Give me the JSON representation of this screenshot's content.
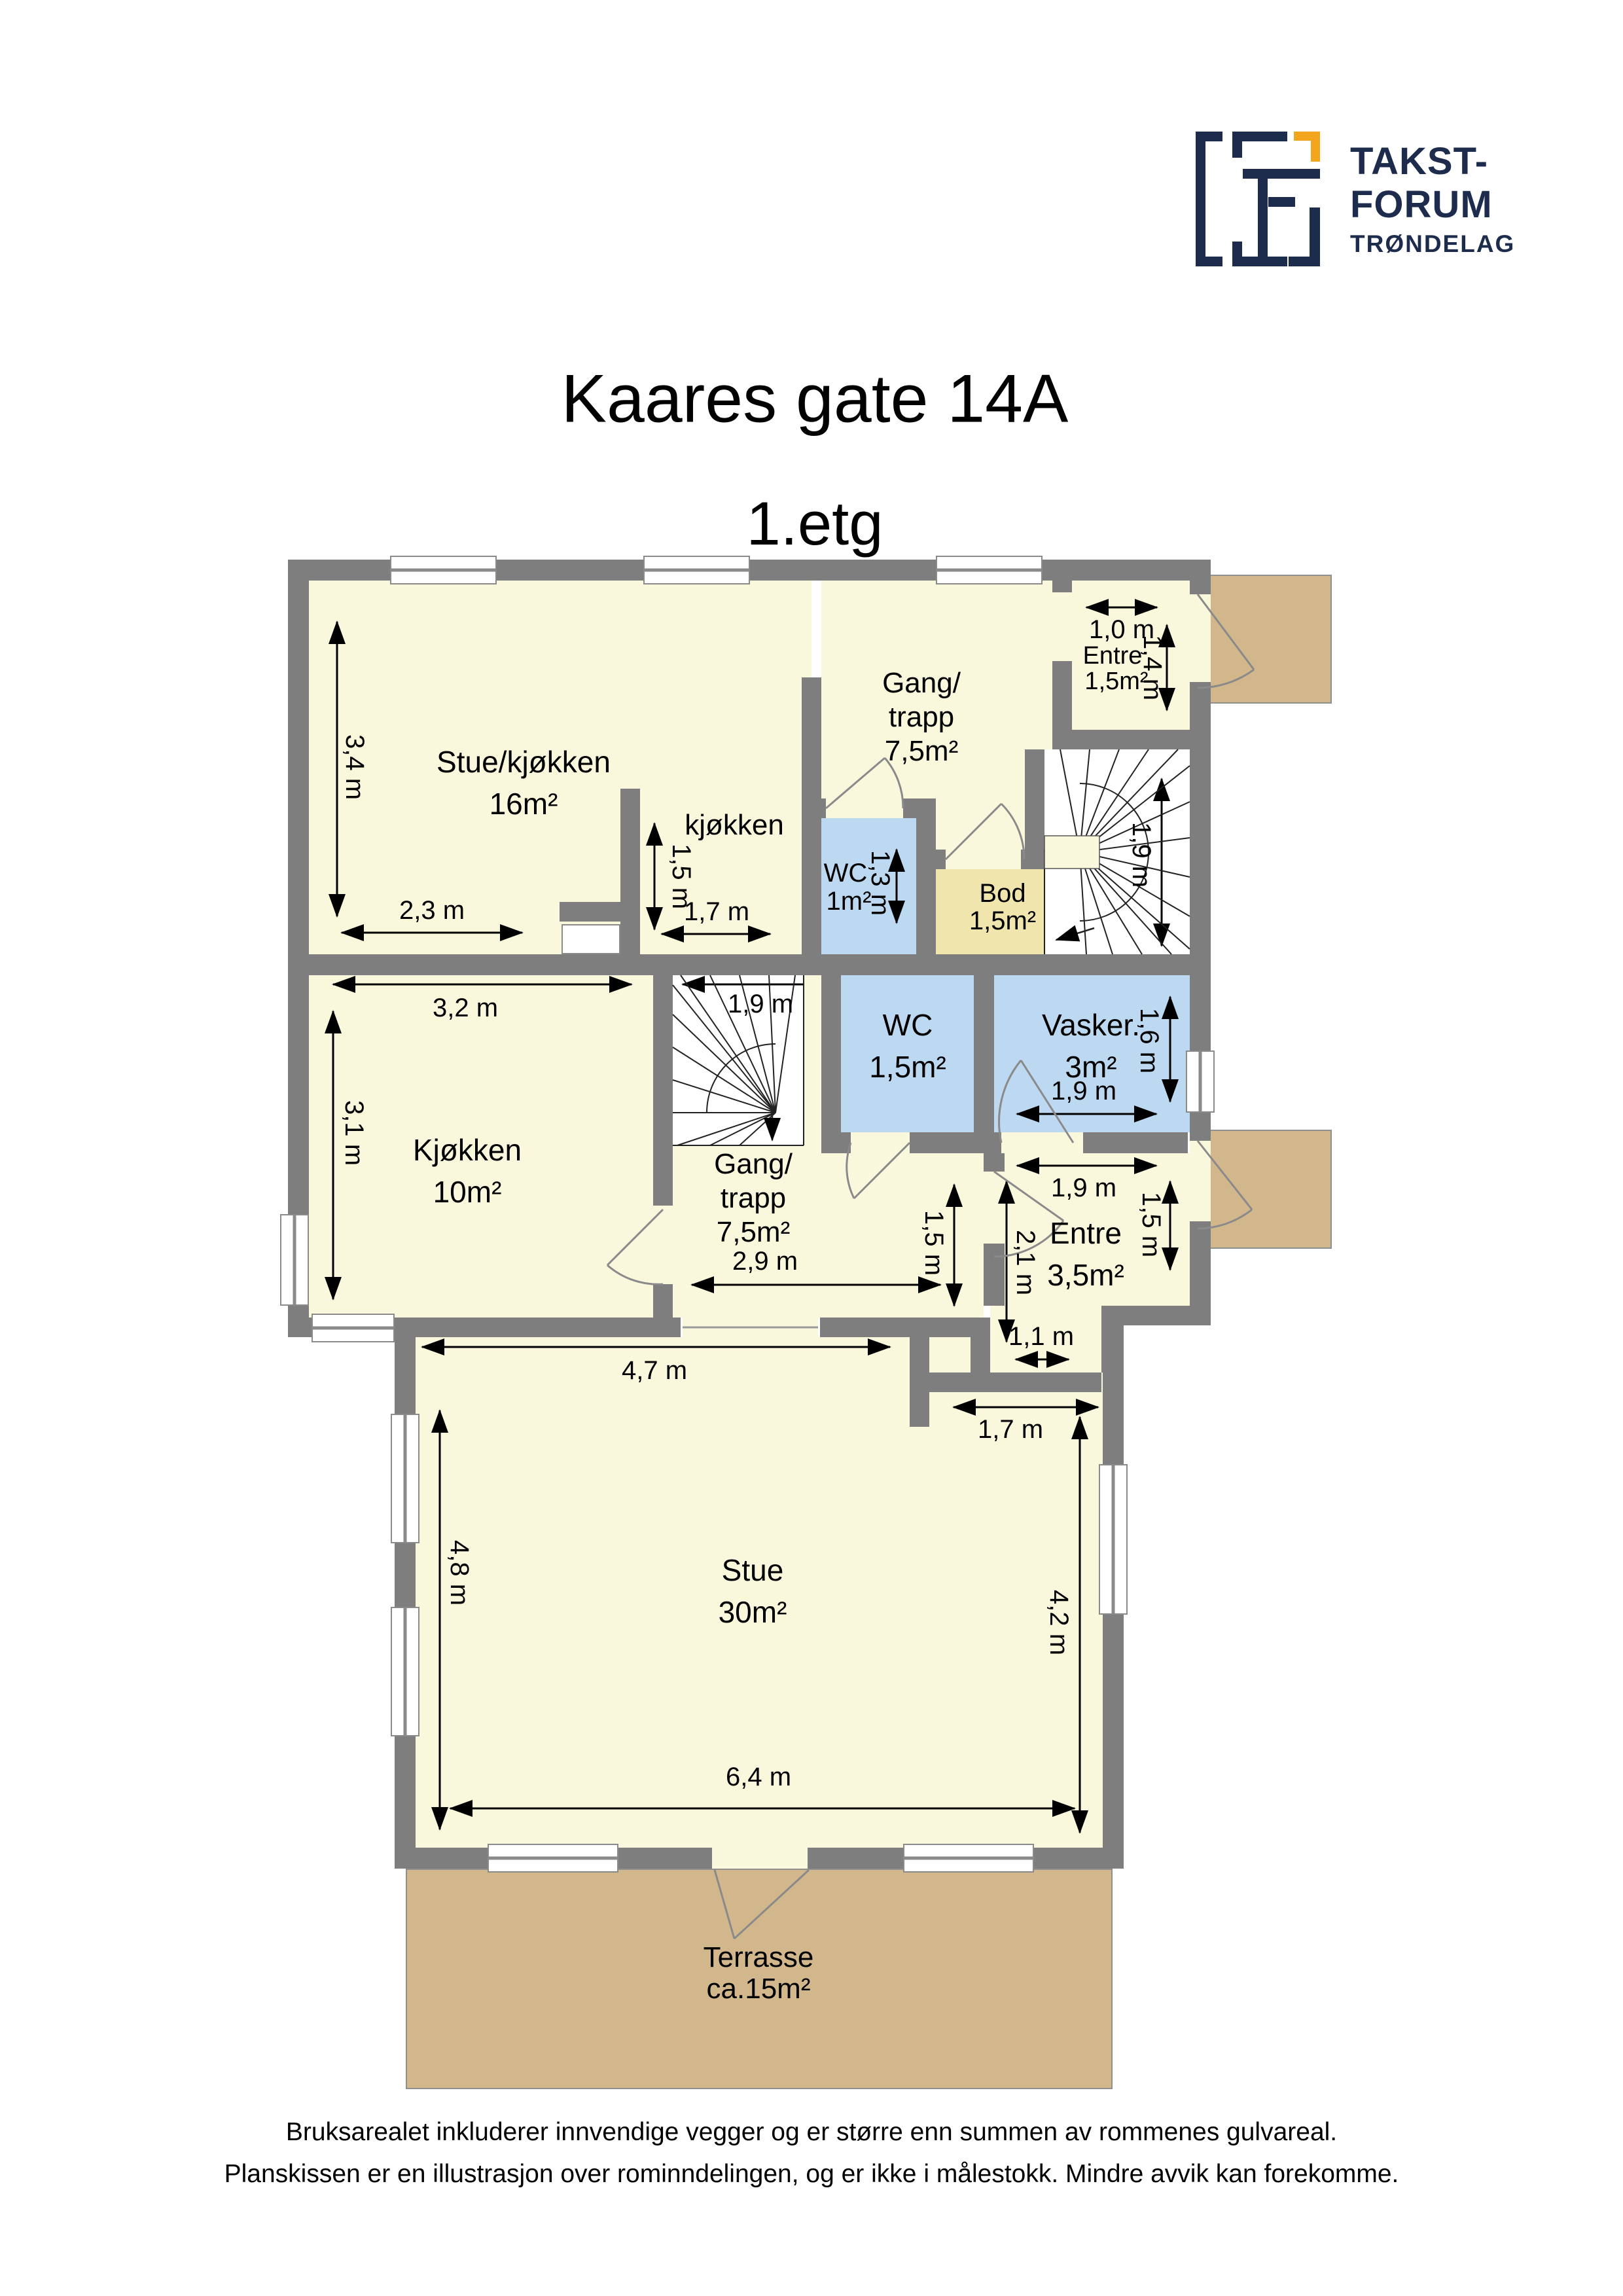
{
  "logo": {
    "line1": "TAKST-",
    "line2": "FORUM",
    "line3": "TRØNDELAG"
  },
  "header": {
    "title": "Kaares gate 14A",
    "subtitle": "1.etg"
  },
  "plan": {
    "rooms": {
      "r1": {
        "name": "Stue/kjøkken",
        "area": "16m²"
      },
      "r2": {
        "name": "kjøkken"
      },
      "r3": {
        "l1": "Gang/",
        "l2": "trapp",
        "l3": "7,5m²"
      },
      "r4": {
        "name": "Entre",
        "area": "1,5m²"
      },
      "r5": {
        "name": "WC",
        "area": "1m²"
      },
      "r6": {
        "name": "Bod",
        "area": "1,5m²"
      },
      "r7": {
        "name": "Kjøkken",
        "area": "10m²"
      },
      "r8": {
        "l1": "Gang/",
        "l2": "trapp",
        "l3": "7,5m²"
      },
      "r9": {
        "name": "WC",
        "area": "1,5m²"
      },
      "r10": {
        "name": "Vasker.",
        "area": "3m²"
      },
      "r11": {
        "name": "Entre",
        "area": "3,5m²"
      },
      "r12": {
        "name": "Stue",
        "area": "30m²"
      },
      "r13": {
        "name": "Terrasse",
        "area": "ca.15m²"
      }
    },
    "m": {
      "m_34": "3,4 m",
      "m_23": "2,3 m",
      "m_15_nook": "1,5 m",
      "m_17_nook": "1,7 m",
      "m_10": "1,0 m",
      "m_14": "1,4 m",
      "m_19_up": "1,9 m",
      "m_13": "1,3 m",
      "m_32": "3,2 m",
      "m_31": "3,1 m",
      "m_19_low": "1,9 m",
      "m_16": "1,6 m",
      "m_19_vask": "1,9 m",
      "m_19_entre": "1,9 m",
      "m_15_entre": "1,5 m",
      "m_21": "2,1 m",
      "m_15_gang": "1,5 m",
      "m_11": "1,1 m",
      "m_29": "2,9 m",
      "m_47": "4,7 m",
      "m_17_stue": "1,7 m",
      "m_48": "4,8 m",
      "m_42": "4,2 m",
      "m_64": "6,4 m"
    }
  },
  "footer": {
    "line1": "Bruksarealet inkluderer innvendige vegger og er større enn summen av rommenes gulvareal.",
    "line2": "Planskissen er en illustrasjon over rominndelingen, og er ikke i målestokk. Mindre avvik kan forekomme."
  },
  "colors": {
    "wall": "#7e7e7e",
    "room": "#faf8dc",
    "wet_room": "#bdd8f1",
    "storage": "#f0e6ad",
    "deck": "#d2b78c",
    "logo_navy": "#1d2b4d",
    "logo_orange": "#f3a51d"
  }
}
